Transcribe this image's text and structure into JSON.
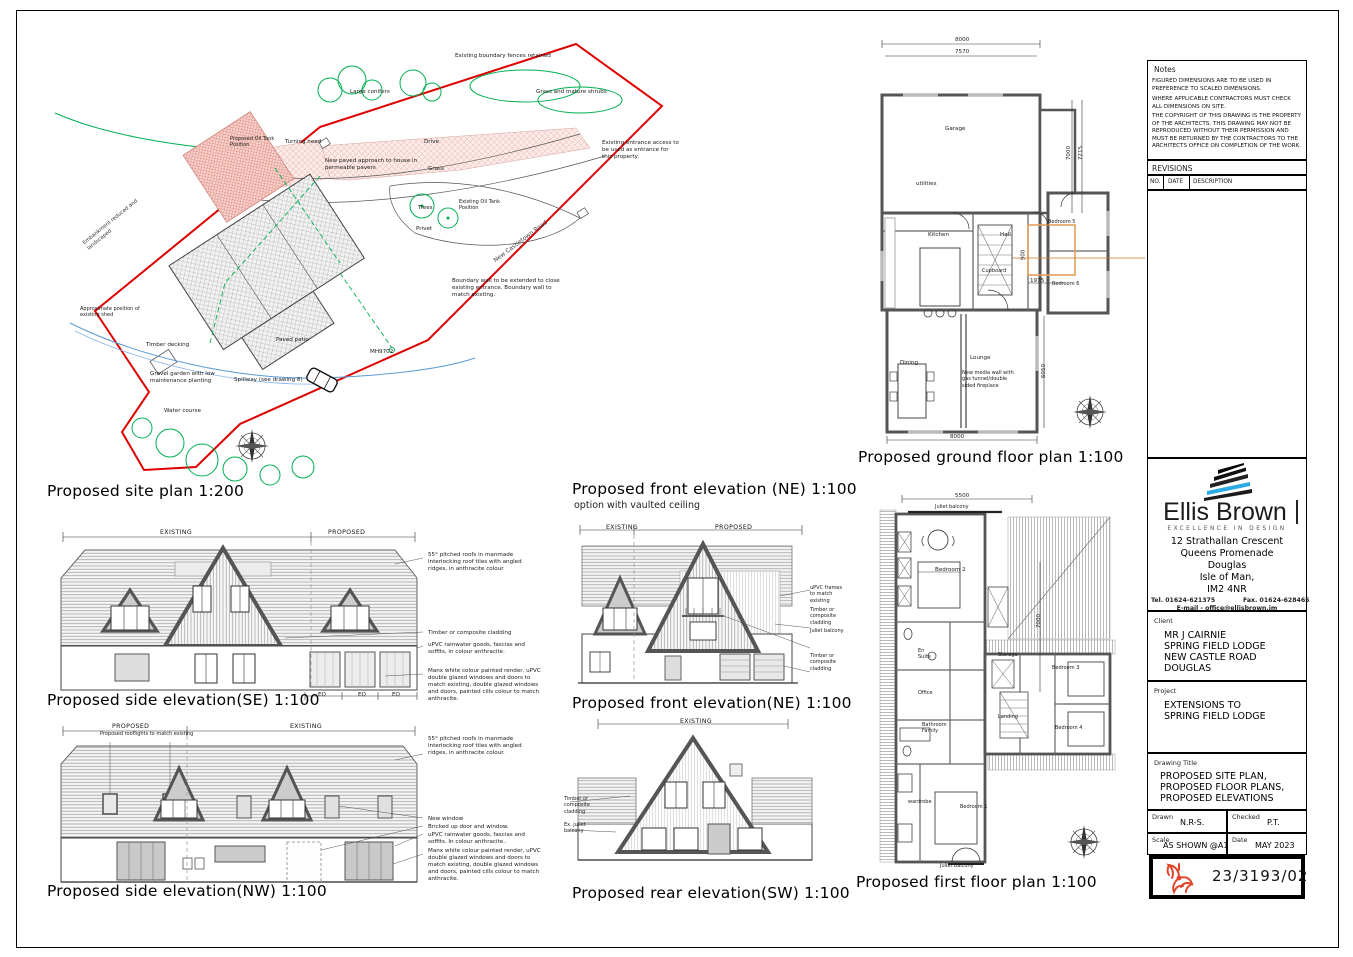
{
  "site": {
    "title": "Proposed site plan 1:200",
    "labels": {
      "fences": "Existing boundary fences retained",
      "conifers": "Large conifers",
      "shrubs": "Grass and mature shrubs",
      "oil_proposed": "Proposed Oil Tank Position",
      "turning": "Turning head",
      "drive": "Drive",
      "paved": "New paved approach to house in permeable pavers",
      "grass": "Grass",
      "entrance": "Existing entrance access to be used as entrance for this property.",
      "oil_existing": "Existing Oil Tank Position",
      "trees": "Trees",
      "privet": "Privet",
      "road": "New Castletown Road",
      "wall": "Boundary wall to be extended to close existing entrance. Boundary wall to match existing.",
      "shed": "Approximate position of existing shed",
      "embankment": "Embankment reduced and landscaped",
      "decking": "Timber decking",
      "patio": "Paved patio",
      "mh": "MH9702",
      "gravel": "Gravel garden with low maintenance planting",
      "spillway": "Spillway (see drawing 8)",
      "water": "Water course"
    }
  },
  "gf": {
    "title": "Proposed ground floor plan 1:100",
    "rooms": {
      "garage": "Garage",
      "utilities": "utilities",
      "kitchen": "Kitchen",
      "hall": "Hall",
      "cupboard": "Cupboard",
      "bed5": "Bedroom 5",
      "bed6": "Bedroom 6",
      "dining": "Dining",
      "lounge": "Lounge"
    },
    "dims": {
      "w1": "8000",
      "w2": "7570",
      "h1": "7000",
      "h2": "7215",
      "bed": "1975",
      "wc": "900",
      "lounge": "6050",
      "bottom": "8000"
    },
    "media": "New media wall with gas tunnel/double sided fireplace"
  },
  "ff": {
    "title": "Proposed first floor plan 1:100",
    "rooms": {
      "bed2": "Bedroom 2",
      "ensuite": "En Suite",
      "office": "Office",
      "storage": "Storage",
      "landing": "Landing",
      "bath": "Bathroom Family",
      "bed3": "Bedroom 3",
      "bed4": "Bedroom 4",
      "bed1": "Bedroom 1",
      "wardrobe": "wardrobe"
    },
    "dims": {
      "w": "5500",
      "h": "7000"
    },
    "juliet": "Juliet balcony"
  },
  "elev": {
    "se": {
      "title": "Proposed side elevation(SE) 1:100",
      "existing": "EXISTING",
      "proposed": "PROPOSED",
      "eq": "EQ",
      "n_roof": "55° pitched roofs in manmade interlocking roof tiles with angled ridges, in anthracite colour",
      "n_clad": "Timber or composite cladding",
      "n_rain": "uPVC rainwater goods, fascias and soffits, in colour anthracite.",
      "n_render": "Manx white colour painted render, uPVC double glazed windows and doors to match existing, double glazed windows and doors, painted cills colour to match anthracite."
    },
    "nev": {
      "title": "Proposed front elevation (NE) 1:100",
      "sub": "option with vaulted ceiling",
      "existing": "EXISTING",
      "proposed": "PROPOSED",
      "n_frames": "uPVC frames to match existing",
      "n_clad": "Timber or composite cladding",
      "n_juliet": "Juliet balcony",
      "n_clad2": "Timber or composite cladding"
    },
    "ne": {
      "title": "Proposed front elevation(NE) 1:100"
    },
    "nw": {
      "title": "Proposed side elevation(NW) 1:100",
      "proposed": "PROPOSED",
      "existing": "EXISTING",
      "rooflights": "Proposed rooflights to match existing",
      "n_roof": "55° pitched roofs in manmade interlocking roof tiles with angled ridges, in anthracite colour.",
      "n_window": "New window",
      "n_bricked": "Bricked up door and window.",
      "n_rain": "uPVC rainwater goods, fascias and soffits. In colour anthracite..",
      "n_render": "Manx white colour painted render, uPVC double glazed windows and doors to match existing, double glazed windows and doors, painted cills colour to match anthracite."
    },
    "sw": {
      "title": "Proposed rear elevation(SW) 1:100",
      "existing": "EXISTING",
      "n_clad": "Timber or composite cladding",
      "n_juliet": "Ex. juliet balcony"
    }
  },
  "tb": {
    "notes_label": "Notes",
    "notes1": "FIGURED DIMENSIONS ARE TO BE USED IN PREFERENCE TO SCALED DIMENSIONS.",
    "notes2": "WHERE APPLICABLE CONTRACTORS MUST CHECK ALL DIMENSIONS ON SITE.",
    "notes3": "THE COPYRIGHT OF THIS DRAWING IS THE PROPERTY OF THE ARCHITECTS. THIS DRAWING MAY NOT BE REPRODUCED WITHOUT THEIR PERMISSION AND MUST BE RETURNED BY THE CONTRACTORS TO THE ARCHITECTS OFFICE ON COMPLETION OF THE WORK.",
    "revisions_label": "REVISIONS",
    "col_no": "NO.",
    "col_date": "DATE",
    "col_desc": "DESCRIPTION",
    "brand": "Ellis Brown",
    "tagline": "EXCELLENCE IN DESIGN",
    "addr1": "12 Strathallan Crescent",
    "addr2": "Queens Promenade",
    "addr3": "Douglas",
    "addr4": "Isle of Man,",
    "addr5": "IM2 4NR",
    "tel": "Tel. 01624-621375",
    "fax": "Fax. 01624-628465",
    "email": "E-mail - office@ellisbrown.im",
    "client_label": "Client",
    "client1": "MR J CAIRNIE",
    "client2": "SPRING FIELD LODGE",
    "client3": "NEW CASTLE ROAD",
    "client4": "DOUGLAS",
    "project_label": "Project",
    "project1": "EXTENSIONS TO",
    "project2": "SPRING FIELD LODGE",
    "dt_label": "Drawing Title",
    "dt1": "PROPOSED SITE PLAN,",
    "dt2": "PROPOSED FLOOR PLANS,",
    "dt3": "PROPOSED ELEVATIONS",
    "drawn_label": "Drawn",
    "drawn": "N.R-S.",
    "checked_label": "Checked",
    "checked": "P.T.",
    "scale_label": "Scale",
    "scale": "AS SHOWN @A1",
    "date_label": "Date",
    "date": "MAY 2023",
    "number": "23/3193/02",
    "accent_cyan": "#29abe2",
    "accent_red": "#e0452a",
    "boundary_red": "#dd0000",
    "veg_green": "#00b050"
  }
}
